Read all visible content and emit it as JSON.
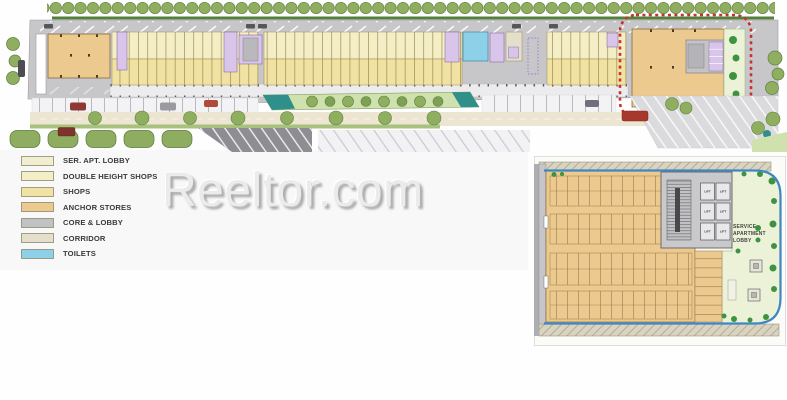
{
  "watermark": {
    "text": "Reeltor.com"
  },
  "legend": {
    "items": [
      {
        "label": "SER. APT. LOBBY",
        "color": "#f2eed2"
      },
      {
        "label": "DOUBLE HEIGHT SHOPS",
        "color": "#f4eec6"
      },
      {
        "label": "SHOPS",
        "color": "#f0e2a2"
      },
      {
        "label": "ANCHOR STORES",
        "color": "#ecc98e"
      },
      {
        "label": "CORE & LOBBY",
        "color": "#c2c2c4"
      },
      {
        "label": "CORRIDOR",
        "color": "#e4dfca"
      },
      {
        "label": "TOILETS",
        "color": "#8ed0e8"
      }
    ]
  },
  "inset": {
    "lobby_lines": [
      "SERVICE",
      "APARTMENT",
      "LOBBY"
    ],
    "lift_label": "LIFT"
  },
  "palette": {
    "road_gray": "#c7c7ca",
    "tree_green": "#8fae5f",
    "hedge_green": "#55803c",
    "grass_green": "#cfe2ad",
    "water_teal": "#2f8f8a",
    "anchor_stores": "#ecc98e",
    "shops": "#f0e2a2",
    "double_height_shops": "#f4eec6",
    "corridor": "#e4dfca",
    "toilets": "#8ed0e8",
    "purple_core": "#d9c5e9",
    "lobby_green": "#ecf2d8",
    "walkway": "#ececee",
    "wall_tan": "#d9d3c0",
    "plant_green": "#3f9240",
    "highlight_red": "#c8322e"
  }
}
